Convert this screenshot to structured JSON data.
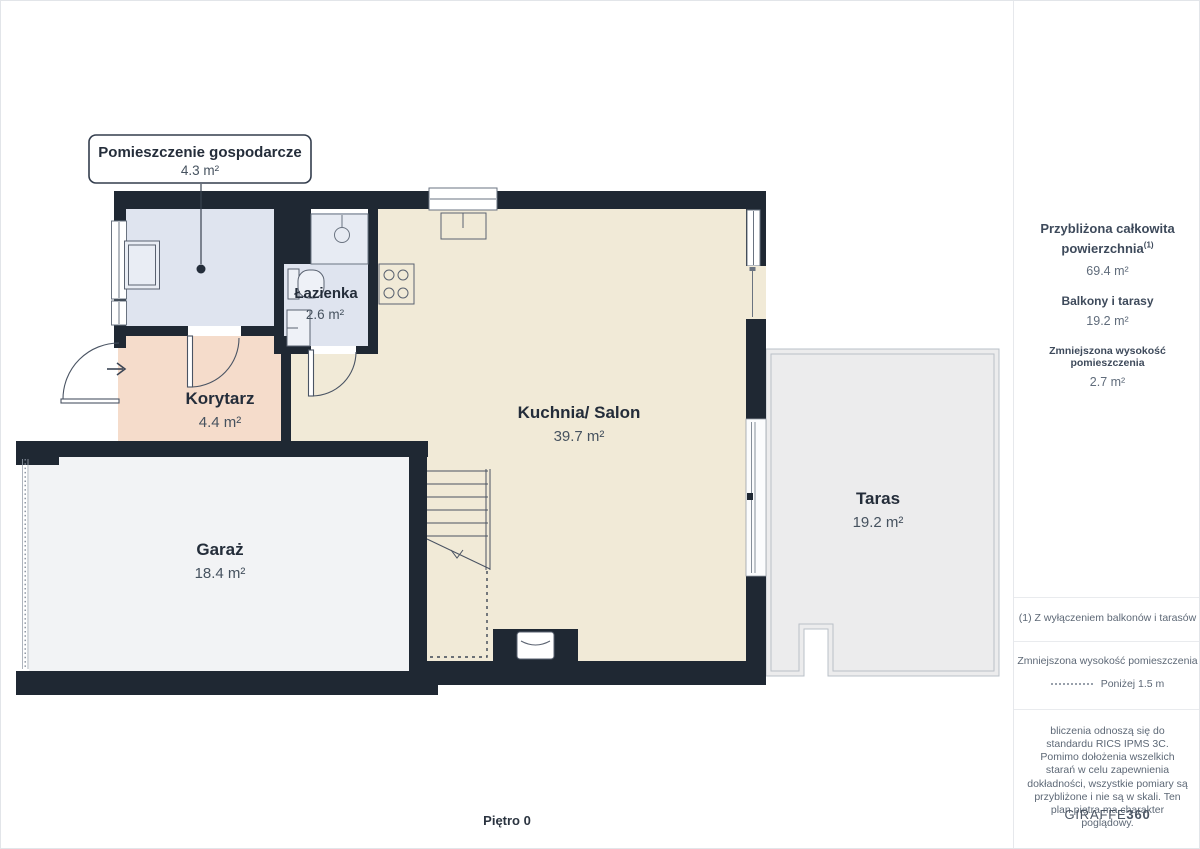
{
  "plan": {
    "floor_label": "Piętro 0",
    "callout": {
      "title": "Pomieszczenie gospodarcze",
      "area": "4.3 m²"
    },
    "rooms": {
      "lazienka": {
        "name": "Łazienka",
        "area": "2.6 m²"
      },
      "korytarz": {
        "name": "Korytarz",
        "area": "4.4 m²"
      },
      "kuchnia": {
        "name": "Kuchnia/ Salon",
        "area": "39.7 m²"
      },
      "garaz": {
        "name": "Garaż",
        "area": "18.4 m²"
      },
      "taras": {
        "name": "Taras",
        "area": "19.2 m²"
      }
    }
  },
  "sidebar": {
    "summary": [
      {
        "label": "Przybliżona całkowita powierzchnia",
        "sup": "(1)",
        "value": "69.4 m²"
      },
      {
        "label": "Balkony i tarasy",
        "value": "19.2 m²"
      },
      {
        "label": "Zmniejszona wysokość pomieszczenia",
        "value": "2.7 m²"
      }
    ],
    "footnote": "(1) Z wyłączeniem balkonów i tarasów",
    "legend": {
      "title": "Zmniejszona wysokość pomieszczenia",
      "item": "Poniżej 1.5 m"
    },
    "disclaimer": "bliczenia odnoszą się do standardu RICS IPMS 3C. Pomimo dołożenia wszelkich starań w celu zapewnienia dokładności, wszystkie pomiary są przybliżone i nie są w skali. Ten plan piętra ma charakter poglądowy.",
    "logo": {
      "name": "GIRAFFE",
      "suffix": "360"
    }
  },
  "colors": {
    "wall": "#1f2833",
    "kitchen_floor": "#f1ead7",
    "corridor_floor": "#f5dccb",
    "bathroom_floor": "#dfe4ef",
    "garage_floor": "#f2f3f5",
    "terrace_floor": "#ececed",
    "label_text": "#242d3a",
    "area_text": "#46525f"
  }
}
